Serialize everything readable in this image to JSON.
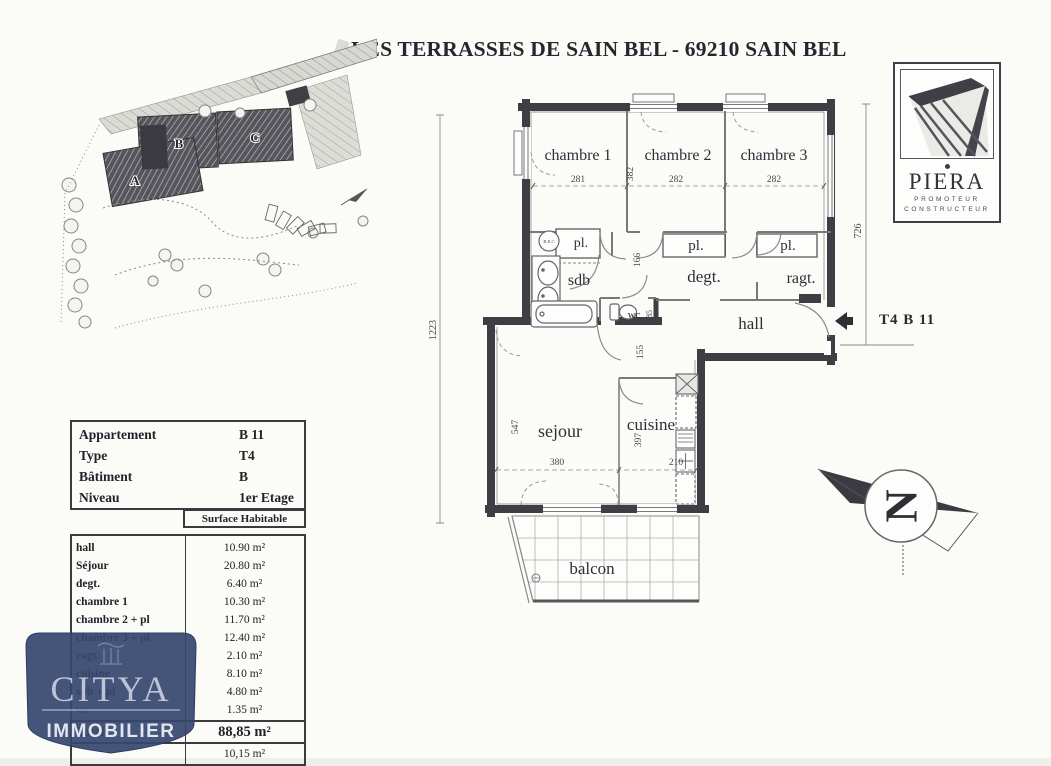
{
  "page": {
    "title": "LES TERRASSES DE SAIN BEL - 69210 SAIN BEL"
  },
  "piera_logo": {
    "name": "PIERA",
    "subtitle1": "PROMOTEUR",
    "subtitle2": "CONSTRUCTEUR"
  },
  "citya_logo": {
    "name": "CITYA",
    "subtitle": "IMMOBILIER"
  },
  "plan_ref": "T4 B 11",
  "compass_letter": "N",
  "site_plan": {
    "building_a": "A",
    "building_b": "B",
    "building_c": "C"
  },
  "floor_plan": {
    "rooms": {
      "chambre1": "chambre 1",
      "chambre2": "chambre 2",
      "chambre3": "chambre 3",
      "pl1": "pl.",
      "pl2": "pl.",
      "pl3": "pl.",
      "sdb": "sdb",
      "degt": "degt.",
      "ragt": "ragt.",
      "hall": "hall",
      "wc": "wc",
      "sejour": "sejour",
      "cuisine": "cuisine",
      "balcon": "balcon",
      "bec": "B.E.C"
    },
    "dims": {
      "chambre1_w": "281",
      "chambre2_w": "282",
      "chambre3_w": "282",
      "chambre_h": "382",
      "left_total": "1223",
      "right_total": "726",
      "corridor": "166",
      "wc_w": "85",
      "passage": "155",
      "sejour_h": "547",
      "sejour_w": "380",
      "cuisine_h": "397",
      "cuisine_w": "210"
    }
  },
  "table": {
    "info": [
      {
        "label": "Appartement",
        "value": "B 11"
      },
      {
        "label": "Type",
        "value": "T4"
      },
      {
        "label": "Bâtiment",
        "value": "B"
      },
      {
        "label": "Niveau",
        "value": "1er Etage"
      }
    ],
    "surface_header": "Surface Habitable",
    "rows": [
      {
        "label": "hall",
        "value": "10.90 m²"
      },
      {
        "label": "Séjour",
        "value": "20.80 m²"
      },
      {
        "label": "degt.",
        "value": "6.40 m²"
      },
      {
        "label": "chambre 1",
        "value": "10.30 m²"
      },
      {
        "label": "chambre 2 + pl",
        "value": "11.70 m²"
      },
      {
        "label": "chambre 3 + pl",
        "value": "12.40 m²"
      },
      {
        "label": "ragt.",
        "value": "2.10 m²"
      },
      {
        "label": "cuisine",
        "value": "8.10 m²"
      },
      {
        "label": "sdb + pl",
        "value": "4.80 m²"
      },
      {
        "label": "wc",
        "value": "1.35 m²"
      }
    ],
    "total": {
      "label": "Total",
      "value": "88,85 m²"
    },
    "overflow": {
      "value": "10,15 m²"
    }
  }
}
